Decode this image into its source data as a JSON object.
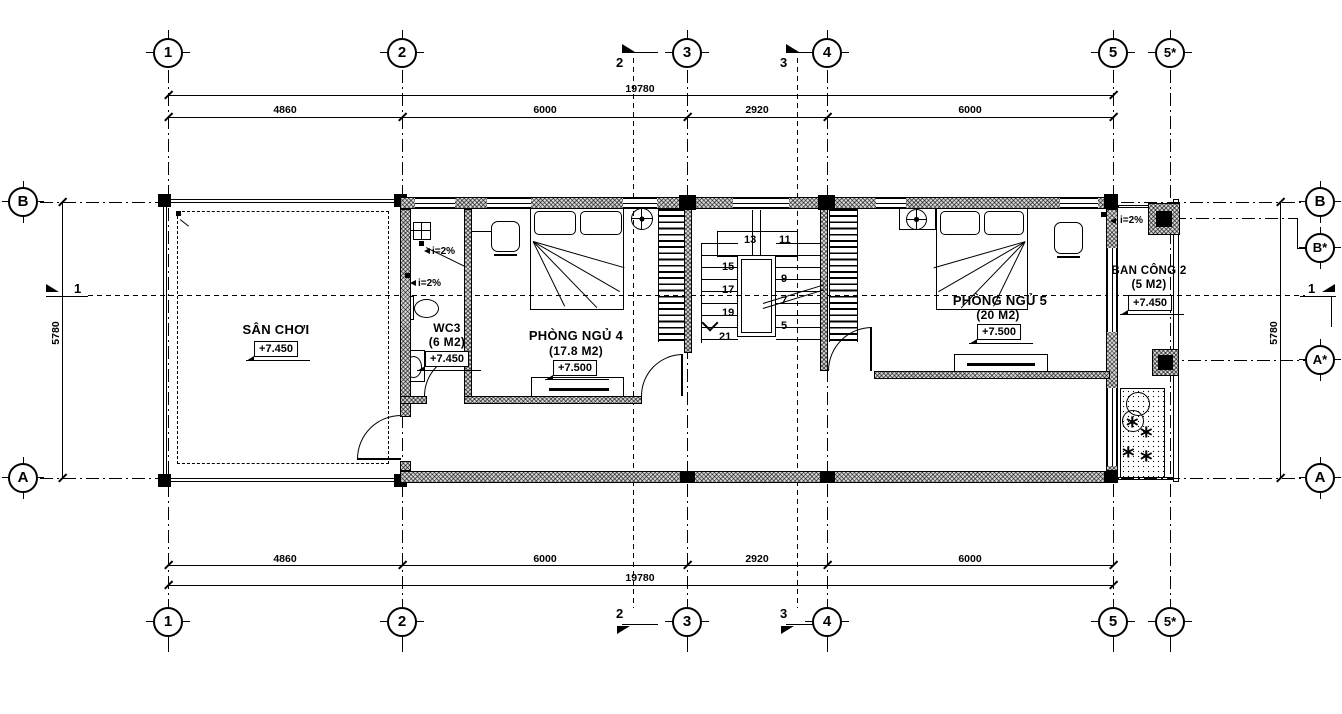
{
  "drawing": {
    "grid_cols": [
      "1",
      "2",
      "3",
      "4",
      "5",
      "5*"
    ],
    "grid_rows_left": [
      "B",
      "A"
    ],
    "grid_rows_right": [
      "B",
      "B*",
      "A*",
      "A"
    ],
    "dim_total": "19780",
    "dim_segments": [
      "4860",
      "6000",
      "2920",
      "6000"
    ],
    "dim_side": "5780",
    "section_1": "1",
    "section_2": "2",
    "section_3": "3"
  },
  "rooms": {
    "san_choi": {
      "name": "SÂN CHƠI",
      "level": "+7.450"
    },
    "wc3": {
      "name": "WC3",
      "area": "(6 M2)",
      "level": "+7.450"
    },
    "bedroom4": {
      "name": "PHÒNG NGỦ 4",
      "area": "(17.8 M2)",
      "level": "+7.500"
    },
    "bedroom5": {
      "name": "PHÒNG NGỦ 5",
      "area": "(20 M2)",
      "level": "+7.500"
    },
    "balcony2": {
      "name": "BAN CÔNG 2",
      "area": "(5 M2)",
      "level": "+7.450"
    }
  },
  "stair_steps": {
    "n5": "5",
    "n7": "7",
    "n9": "9",
    "n11": "11",
    "n13": "13",
    "n15": "15",
    "n17": "17",
    "n19": "19",
    "n21": "21"
  },
  "annotations": {
    "slope": "i=2%"
  }
}
